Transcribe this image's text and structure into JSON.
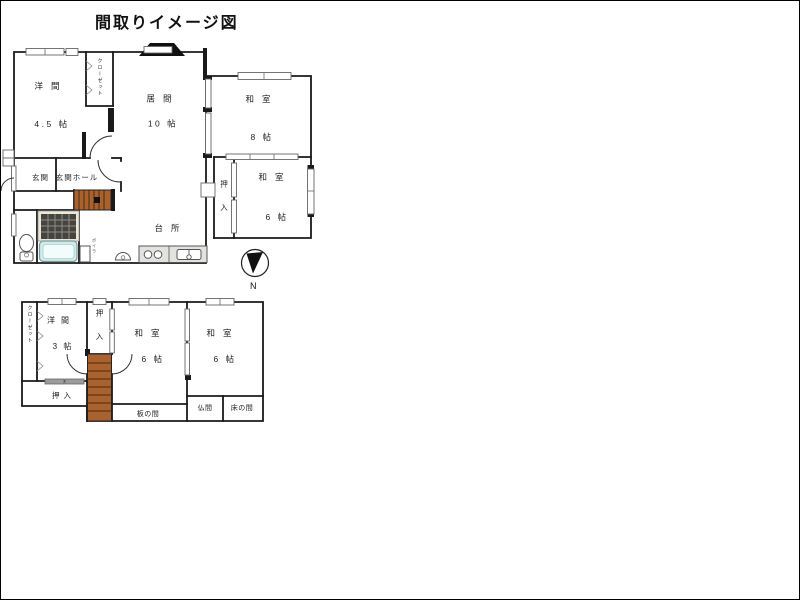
{
  "title": "間取りイメージ図",
  "compass": {
    "label": "N"
  },
  "colors": {
    "wall": "#1a1a1a",
    "stairs": "#a9622e",
    "stairs_line": "#4a2a10",
    "tile": "#45443e",
    "tile_line": "#8d8d86",
    "tile_frame": "#eae6d8",
    "tub": "#cdeceb",
    "tub_inner": "#f3fcfc",
    "slider_gray": "#9c9c9c",
    "counter": "#e2e2de"
  },
  "floor1": {
    "rooms": {
      "youma": {
        "name": "洋間",
        "size": "4.5 帖"
      },
      "closet": {
        "name": "クローゼット"
      },
      "ima": {
        "name": "居間",
        "size": "10 帖"
      },
      "washitsu8": {
        "name": "和室",
        "size": "8 帖"
      },
      "washitsu6": {
        "name": "和室",
        "size": "6 帖"
      },
      "oshiire": {
        "name": "押入"
      },
      "genkan": {
        "name": "玄関"
      },
      "genkan_hall": {
        "name": "玄関ホール"
      },
      "daidokoro": {
        "name": "台所"
      },
      "boiler": {
        "name": "ボイラ"
      }
    }
  },
  "floor2": {
    "rooms": {
      "closet": {
        "name": "クローゼット"
      },
      "youma": {
        "name": "洋間",
        "size": "3 帖"
      },
      "oshiire_stair": {
        "name": "押入"
      },
      "washitsu6a": {
        "name": "和室",
        "size": "6 帖"
      },
      "washitsu6b": {
        "name": "和室",
        "size": "6 帖"
      },
      "oshiire_low": {
        "name": "押 入"
      },
      "itanoma": {
        "name": "板の間"
      },
      "butsuma": {
        "name": "仏間"
      },
      "tokonoma": {
        "name": "床の間"
      }
    }
  }
}
